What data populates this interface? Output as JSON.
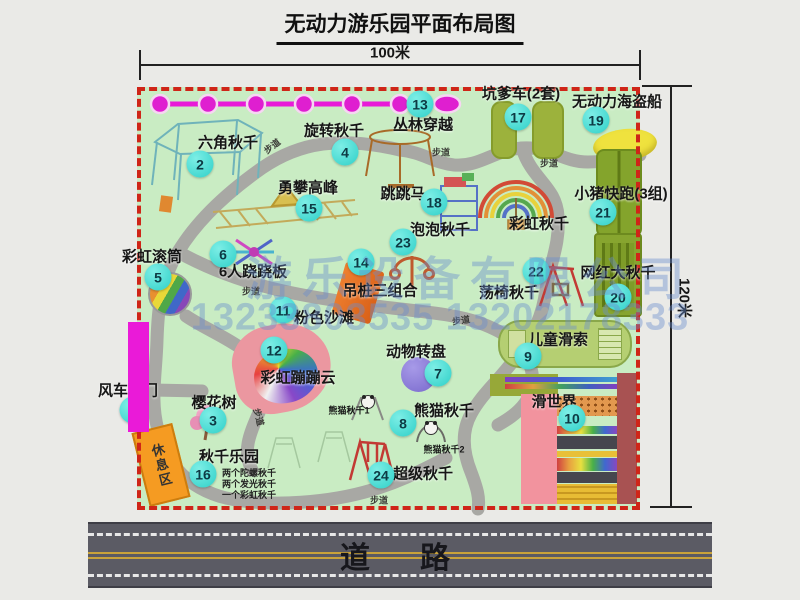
{
  "title": "无动力游乐园平面布局图",
  "dim": {
    "width": "100米",
    "height": "120米"
  },
  "road": "道　路",
  "watermark": {
    "line1": "游乐设备有限公司",
    "line2": "13233803535 13202178333"
  },
  "labels": {
    "trail": "步道",
    "rest": "休息区",
    "rainbow_swing": "彩虹秋千",
    "panda1": "熊猫秋千1",
    "panda2": "熊猫秋千2"
  },
  "swing_park_notes": [
    "两个陀螺秋千",
    "两个发光秋千",
    "一个彩虹秋千"
  ],
  "attractions": [
    {
      "num": "1",
      "label": "风车大门"
    },
    {
      "num": "2",
      "label": "六角秋千"
    },
    {
      "num": "3",
      "label": "樱花树"
    },
    {
      "num": "4",
      "label": "旋转秋千"
    },
    {
      "num": "5",
      "label": "彩虹滚筒"
    },
    {
      "num": "6",
      "label": "6人跷跷板"
    },
    {
      "num": "7",
      "label": "动物转盘"
    },
    {
      "num": "8",
      "label": "熊猫秋千"
    },
    {
      "num": "9",
      "label": "儿童滑索"
    },
    {
      "num": "10",
      "label": "滑世界"
    },
    {
      "num": "11",
      "label": "粉色沙滩"
    },
    {
      "num": "12",
      "label": "彩虹蹦蹦云"
    },
    {
      "num": "13",
      "label": "丛林穿越"
    },
    {
      "num": "14",
      "label": "吊桩三组合"
    },
    {
      "num": "15",
      "label": "勇攀高峰"
    },
    {
      "num": "16",
      "label": "秋千乐园"
    },
    {
      "num": "17",
      "label": "坑爹车(2套)"
    },
    {
      "num": "18",
      "label": "跳跳马"
    },
    {
      "num": "19",
      "label": "无动力海盗船"
    },
    {
      "num": "20",
      "label": "网红大秋千"
    },
    {
      "num": "21",
      "label": "小猪快跑(3组)"
    },
    {
      "num": "22",
      "label": "荡椅秋千"
    },
    {
      "num": "23",
      "label": "泡泡秋千"
    },
    {
      "num": "24",
      "label": "超级秋千"
    }
  ],
  "colors": {
    "map_green": "#c9ecc3",
    "border_red": "#cf2518",
    "zipline_magenta": "#e81ad8",
    "badge_cyan": "#3fd9d2",
    "road_gray": "#5b5b64"
  }
}
